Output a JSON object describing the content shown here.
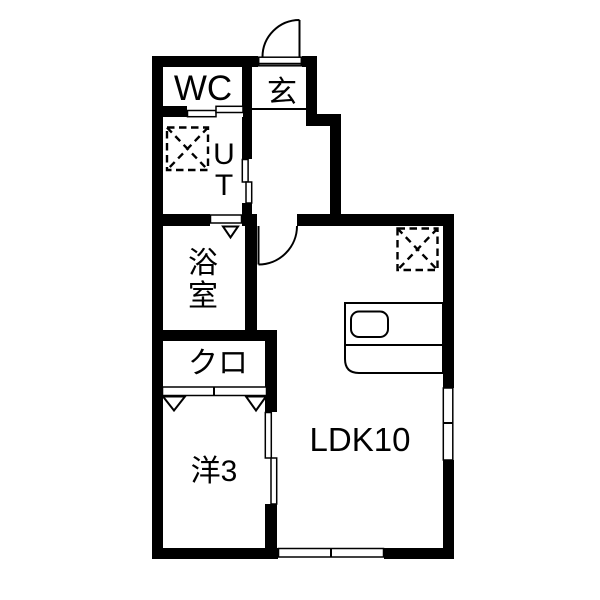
{
  "image_type": "apartment-floor-plan",
  "colors": {
    "wall": "#000000",
    "background": "#ffffff",
    "line": "#000000"
  },
  "rooms": {
    "wc": {
      "label": "WC"
    },
    "entrance": {
      "label": "玄"
    },
    "utility": {
      "chars": [
        "U",
        "T"
      ]
    },
    "bathroom": {
      "chars": [
        "浴",
        "室"
      ]
    },
    "closet": {
      "label": "クロ"
    },
    "western_room": {
      "label": "洋3"
    },
    "ldk": {
      "label": "LDK10"
    }
  },
  "fixtures": {
    "washer": "washing-machine-dashed-box",
    "fridge": "refrigerator-dashed-box",
    "kitchen": "kitchen-counter-with-sink"
  }
}
